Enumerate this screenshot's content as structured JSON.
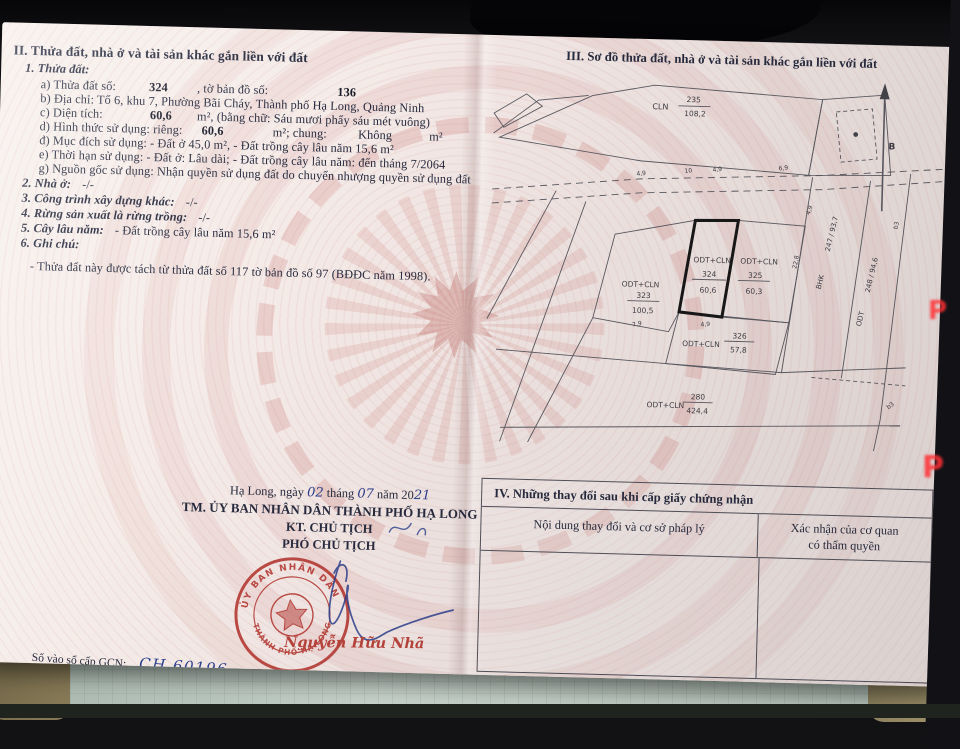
{
  "section2": {
    "heading": "II. Thửa đất, nhà ở và tài sản khác gắn liền với đất",
    "item1": "1. Thửa đất:",
    "a_label": "a) Thửa đất số:",
    "a_value": "324",
    "a_label2": ", tờ bản đồ số:",
    "a_value2": "136",
    "b": "b) Địa chỉ:  Tổ 6, khu 7, Phường Bãi Cháy, Thành phố Hạ Long, Quảng Ninh",
    "c_label": "c) Diện tích:",
    "c_value": "60,6",
    "c_rest": "m², (bằng chữ: Sáu mươi phẩy sáu mét vuông)",
    "d_label": "d) Hình thức sử dụng: riêng:",
    "d_v1": "60,6",
    "d_mid": "m²; chung:",
    "d_v2": "Không",
    "d_end": "m²",
    "dd": "đ) Mục đích sử dụng:  - Đất ở 45,0 m², - Đất trồng cây lâu năm 15,6 m²",
    "e": "e) Thời hạn sử dụng:  - Đất ở: Lâu dài; - Đất trồng cây lâu năm: đến tháng 7/2064",
    "g": "g) Nguồn gốc sử dụng: Nhận quyền sử dụng đất do chuyển nhượng quyền sử dụng đất",
    "item2_t": "2. Nhà ở:",
    "item2_v": "-/-",
    "item3_t": "3. Công trình xây dựng khác:",
    "item3_v": "-/-",
    "item4_t": "4. Rừng sản xuất là rừng trồng:",
    "item4_v": "-/-",
    "item5_t": "5. Cây lâu năm:",
    "item5_v": "- Đất trồng cây lâu năm 15,6 m²",
    "item6_t": "6. Ghi chú:",
    "note": "- Thửa đất này được tách từ thửa đất số 117 tờ bản đồ số 97 (BĐĐC năm 1998)."
  },
  "section3": {
    "heading": "III. Sơ đồ thửa đất, nhà ở và tài sản khác gắn liền với đất",
    "north": "B",
    "parcels": {
      "top": {
        "code": "CLN",
        "num": "235",
        "area": "108,2"
      },
      "p323": {
        "code": "ODT+CLN",
        "num": "323",
        "area": "100,5"
      },
      "p324": {
        "code": "ODT+CLN",
        "num": "324",
        "area": "60,6"
      },
      "p325": {
        "code": "ODT+CLN",
        "num": "325",
        "area": "60,3"
      },
      "p326": {
        "code": "ODT+CLN",
        "num": "326",
        "area": "57,8"
      },
      "p280": {
        "code": "ODT+CLN",
        "num": "280",
        "area": "424,4"
      },
      "r247": {
        "code": "BHK",
        "frac": "247 / 93,7"
      },
      "r248": {
        "code": "ODT",
        "frac": "248 / 94,6"
      },
      "b3a": "b3",
      "b3b": "b3"
    },
    "dims": [
      "4,9",
      "10",
      "4,9",
      "6,9",
      "4,9",
      "22,8",
      "7,9",
      "4,9"
    ]
  },
  "section4": {
    "heading": "IV. Những thay đổi sau khi cấp giấy chứng nhận",
    "col1": "Nội dung thay đổi và cơ sở pháp lý",
    "col2_line1": "Xác nhận của cơ quan",
    "col2_line2": "có thẩm quyền"
  },
  "signature": {
    "place_pre": "Hạ Long, ngày",
    "day": "02",
    "thang": "tháng",
    "month": "07",
    "nam": "năm 20",
    "year": "21",
    "line1": "TM. ỦY BAN NHÂN DÂN THÀNH PHỐ HẠ LONG",
    "line2": "KT. CHỦ TỊCH",
    "line3": "PHÓ CHỦ TỊCH",
    "signer": "Nguyễn Hữu Nhã",
    "seal_top": "ỦY BAN NHÂN DÂN",
    "seal_bottom": "THÀNH PHỐ HẠ LONG"
  },
  "registry": {
    "label": "Số vào sổ cấp GCN:",
    "value": "CH 60196"
  },
  "background": {
    "p_indicator": "P"
  },
  "colors": {
    "seal_red": "#b5352f",
    "ink_blue": "#2b3f8c",
    "paper_pink": "#f4e9e6"
  }
}
